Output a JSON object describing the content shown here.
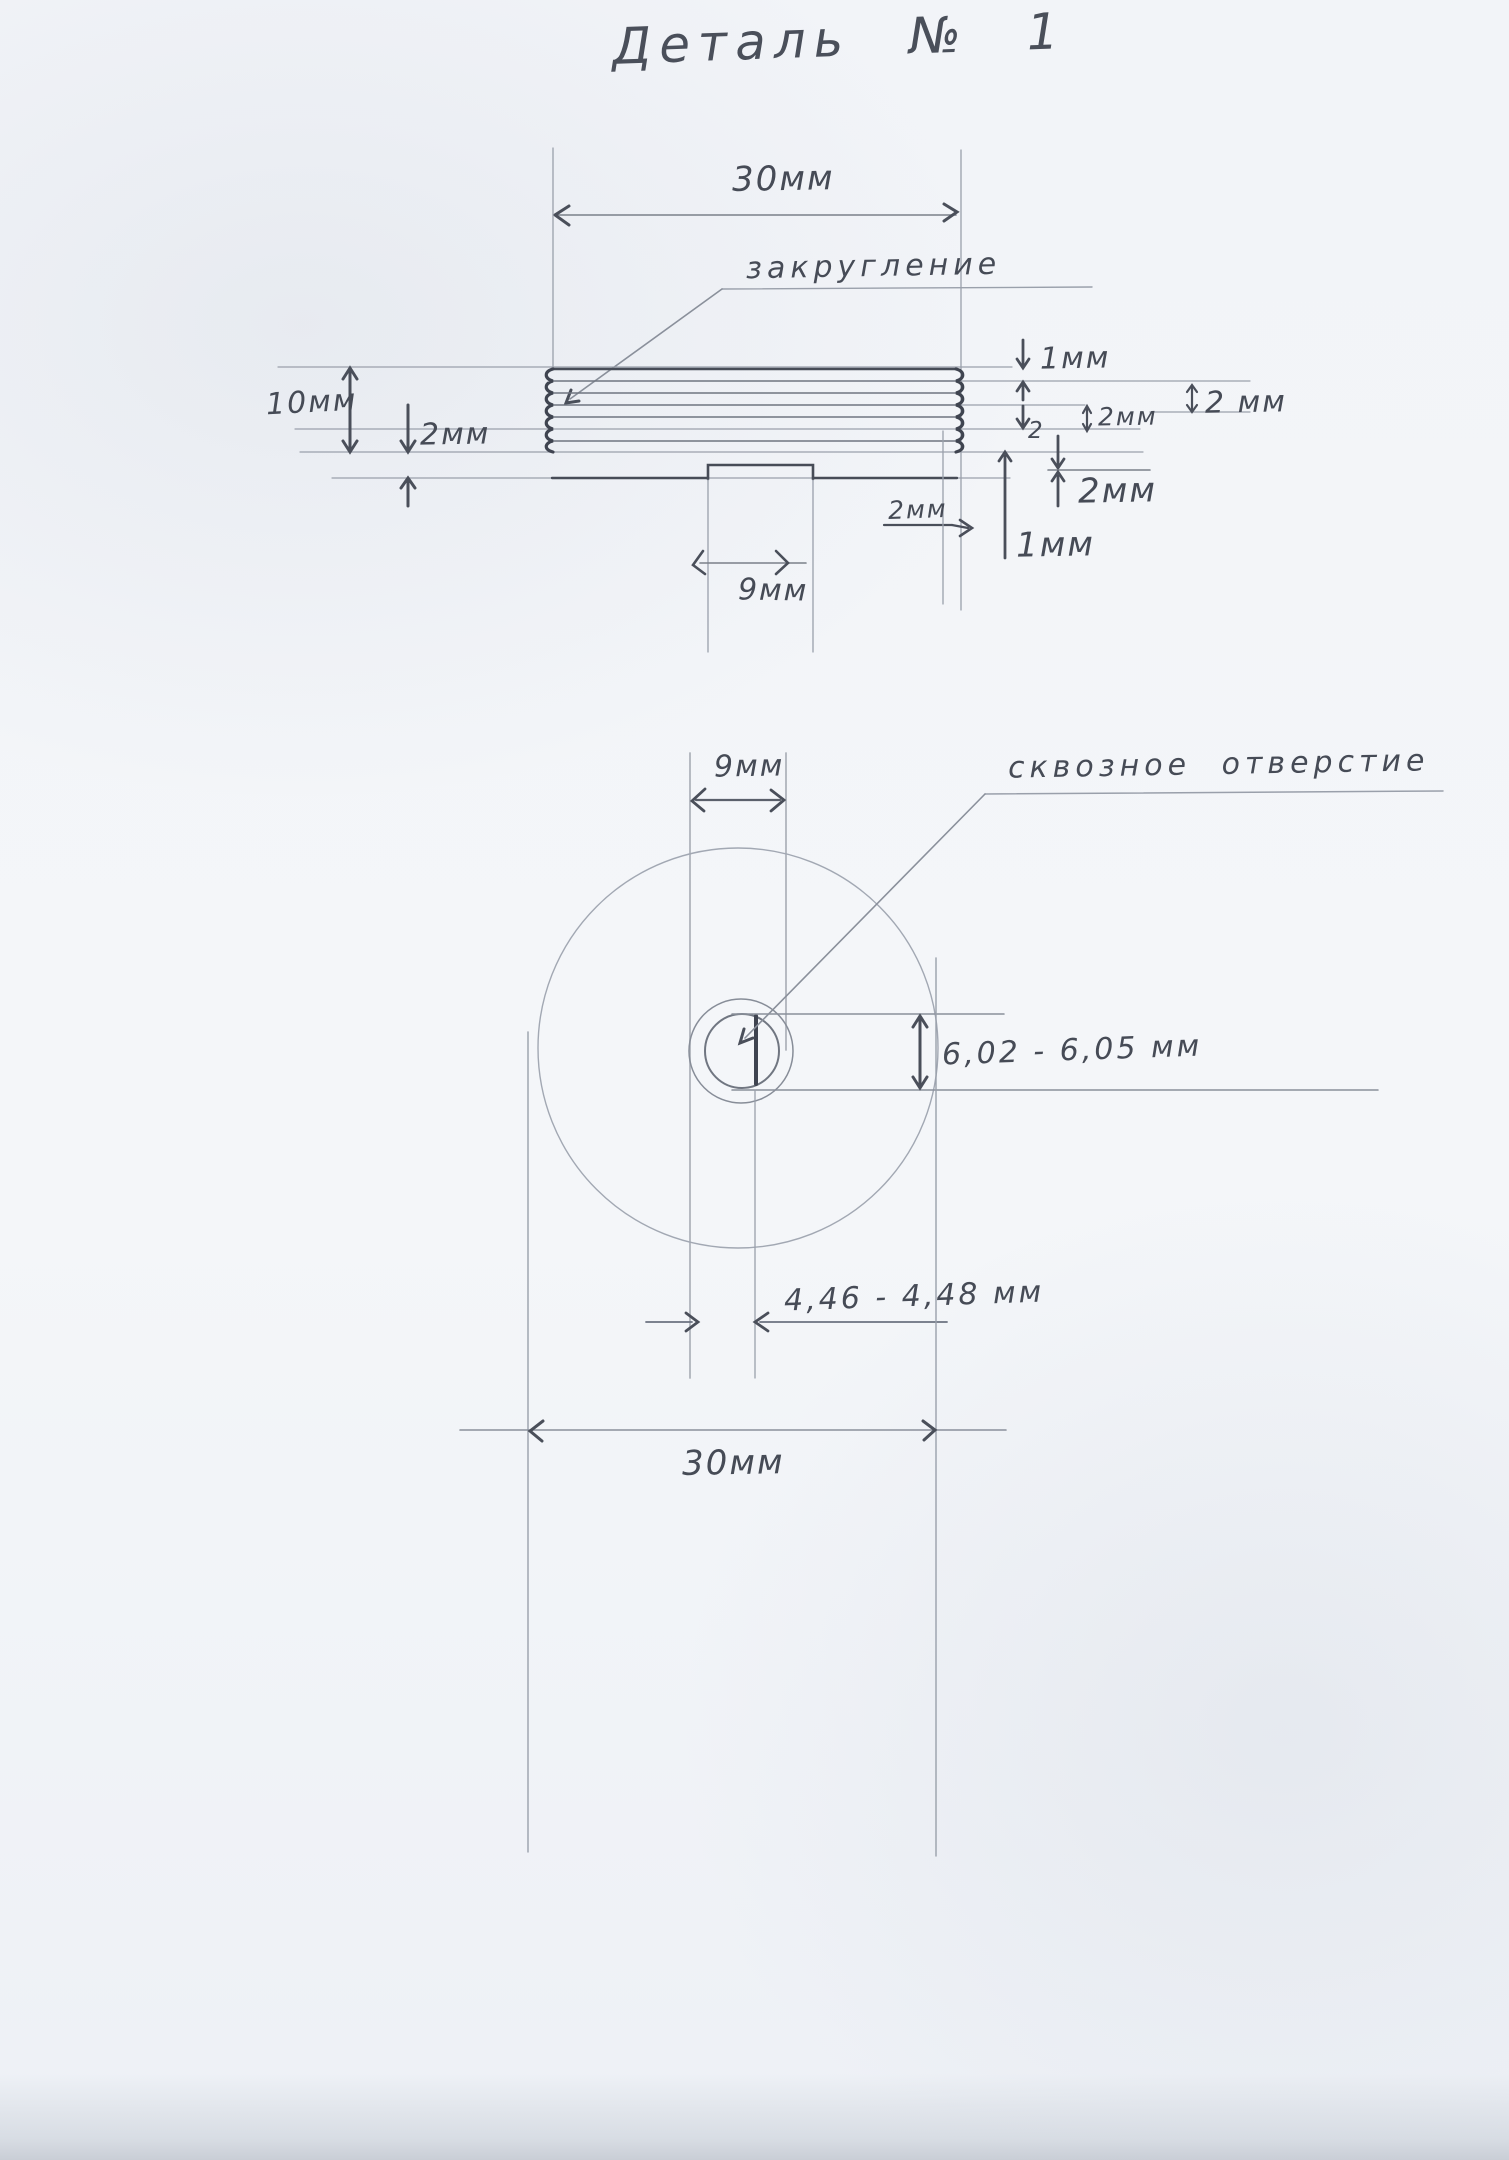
{
  "title": "Деталь № 1",
  "side_view": {
    "width_dim": "30мм",
    "fillet_label": "закругление",
    "height_dim": "10мм",
    "left_step_dim": "2мм",
    "right_stack": {
      "top_1mm": "1мм",
      "mid_2mm_small": "2мм",
      "far_right_2mm": "2 мм",
      "digit_2": "2",
      "lower_2mm": "2мм",
      "bottom_1mm": "1мм"
    },
    "rim_dim": "2мм",
    "slot_width_dim": "9мм"
  },
  "top_view": {
    "slot_width_dim": "9мм",
    "through_hole_label": "сквозное отверстие",
    "hole_height_dim": "6,02 - 6,05 мм",
    "slot_to_hole_dim": "4,46 - 4,48 мм",
    "width_dim": "30мм"
  }
}
